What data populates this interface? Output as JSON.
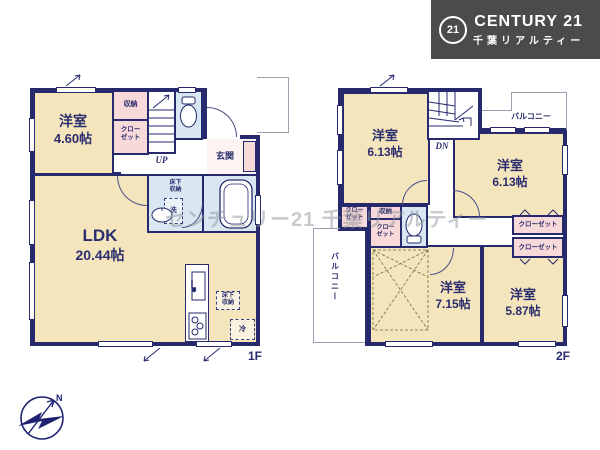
{
  "logo": {
    "circle": "21",
    "brand": "CENTURY 21",
    "subtitle": "千葉リアルティー"
  },
  "watermark": "センチュリー21 千葉リアルティー",
  "compass": {
    "north": "N"
  },
  "labels": {
    "room": "洋室",
    "ldk": "LDK",
    "entrance": "玄関",
    "storage": "収納",
    "closet": "クローゼット",
    "closet_line1": "クロー",
    "closet_line2": "ゼット",
    "underfloor_line1": "床下",
    "underfloor_line2": "収納",
    "balcony": "バルコニー",
    "washer": "洗",
    "fridge": "冷",
    "stairs_up": "UP",
    "stairs_down": "DN"
  },
  "f1": {
    "floor_label": "1F",
    "room_west_size": "4.60帖",
    "ldk_size": "20.44帖"
  },
  "f2": {
    "floor_label": "2F",
    "room_nw_size": "6.13帖",
    "room_ne_size": "6.13帖",
    "room_sw_size": "7.15帖",
    "room_se_size": "5.87帖"
  },
  "colors": {
    "wall": "#262a6d",
    "room_fill": "#f5e5bd",
    "closet_fill": "#f8d9d9",
    "wet_area_fill": "#d8e7f2",
    "logo_bg": "#4b4b4d",
    "text": "#2b2e6e"
  }
}
